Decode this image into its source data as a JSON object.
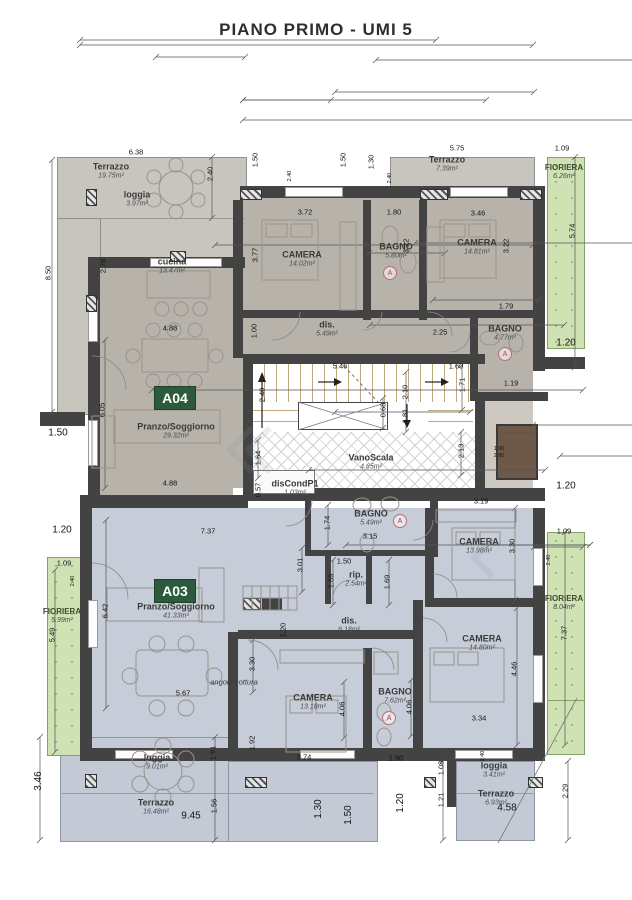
{
  "title": "PIANO PRIMO - UMI 5",
  "badges": {
    "a04": "A04",
    "a03": "A03"
  },
  "colors": {
    "badge_green": "#2c5a3c",
    "apartment_a04_fill": "#b7b2aa",
    "apartment_a03_fill": "#c6ccd8",
    "terrace_fill": "#c8c5bf",
    "terrace_blue_fill": "#c3cad6",
    "fioriera_green": "#cfe2b4",
    "stair_tan": "#ead9b6",
    "wall_dark": "#434343",
    "shaft_brown": "#6e5847"
  },
  "rooms": [
    [
      "Terrazzo",
      "19.75m²",
      111,
      171,
      ""
    ],
    [
      "loggia",
      "3.97m²",
      137,
      199,
      ""
    ],
    [
      "cucina",
      "13.47m²",
      172,
      266,
      ""
    ],
    [
      "CAMERA",
      "14.02m²",
      302,
      259,
      ""
    ],
    [
      "BAGNO",
      "5.80m²",
      396,
      251,
      ""
    ],
    [
      "CAMERA",
      "14.81m²",
      477,
      247,
      ""
    ],
    [
      "Terrazzo",
      "7.39m²",
      447,
      164,
      ""
    ],
    [
      "FIORIERA",
      "6.26m²",
      564,
      172,
      "fiolab"
    ],
    [
      "dis.",
      "5.49m²",
      327,
      329,
      ""
    ],
    [
      "BAGNO",
      "4.77m²",
      505,
      333,
      ""
    ],
    [
      "Pranzo/Soggiorno",
      "29.32m²",
      176,
      431,
      ""
    ],
    [
      "VanoScala",
      "4.65m²",
      371,
      462,
      ""
    ],
    [
      "disCondP1",
      "1.03m²",
      295,
      488,
      ""
    ],
    [
      "BAGNO",
      "5.49m²",
      371,
      518,
      ""
    ],
    [
      "rip.",
      "2.54m²",
      356,
      579,
      ""
    ],
    [
      "dis.",
      "6.18m²",
      349,
      625,
      ""
    ],
    [
      "CAMERA",
      "13.98m²",
      479,
      546,
      ""
    ],
    [
      "CAMERA",
      "14.80m²",
      482,
      643,
      ""
    ],
    [
      "CAMERA",
      "13.18m²",
      313,
      702,
      ""
    ],
    [
      "BAGNO",
      "7.62m²",
      395,
      696,
      ""
    ],
    [
      "FIORIERA",
      "5.99m²",
      62,
      616,
      "fiolab"
    ],
    [
      "FIORIERA",
      "8.04m²",
      564,
      603,
      "fiolab"
    ],
    [
      "angolo cottura",
      "",
      234,
      682,
      "sm"
    ],
    [
      "Pranzo/Soggiorno",
      "41.33m²",
      176,
      611,
      ""
    ],
    [
      "loggia",
      "9.01m²",
      157,
      762,
      ""
    ],
    [
      "Terrazzo",
      "16.48m²",
      156,
      807,
      ""
    ],
    [
      "loggia",
      "3.41m²",
      494,
      770,
      ""
    ],
    [
      "Terrazzo",
      "6.93m²",
      496,
      798,
      ""
    ]
  ],
  "dims": [
    [
      "6.38",
      136,
      152,
      ""
    ],
    [
      "5.75",
      457,
      148,
      ""
    ],
    [
      "1.09",
      562,
      148,
      ""
    ],
    [
      "3.72",
      305,
      212,
      ""
    ],
    [
      "1.80",
      394,
      212,
      ""
    ],
    [
      "3.46",
      478,
      213,
      ""
    ],
    [
      "4.88",
      170,
      328,
      ""
    ],
    [
      "2.25",
      440,
      332,
      ""
    ],
    [
      "1.79",
      506,
      306,
      ""
    ],
    [
      "1.20",
      566,
      343,
      "l"
    ],
    [
      "5.46",
      340,
      366,
      ""
    ],
    [
      "1.60",
      456,
      366,
      ""
    ],
    [
      "1.19",
      511,
      383,
      ""
    ],
    [
      "4.88",
      170,
      483,
      ""
    ],
    [
      "1.20",
      566,
      486,
      "l"
    ],
    [
      "1.50",
      58,
      433,
      "l"
    ],
    [
      "1.20",
      62,
      530,
      "l"
    ],
    [
      "1.09",
      64,
      563,
      ""
    ],
    [
      "7.37",
      208,
      531,
      ""
    ],
    [
      "3.15",
      370,
      536,
      ""
    ],
    [
      "1.50",
      344,
      561,
      ""
    ],
    [
      "3.19",
      481,
      501,
      ""
    ],
    [
      "1.09",
      564,
      531,
      ""
    ],
    [
      "5.67",
      183,
      693,
      ""
    ],
    [
      "3.74",
      304,
      757,
      ""
    ],
    [
      "1.90",
      396,
      758,
      ""
    ],
    [
      "3.34",
      479,
      718,
      ""
    ],
    [
      "4.58",
      507,
      808,
      "l"
    ],
    [
      "9.45",
      191,
      816,
      "l"
    ],
    [
      "1.50",
      255,
      160,
      "r"
    ],
    [
      "1.50",
      343,
      160,
      "r"
    ],
    [
      "1.30",
      371,
      162,
      "r"
    ],
    [
      "2.40",
      210,
      174,
      "r"
    ],
    [
      "5.74",
      572,
      231,
      "r"
    ],
    [
      "8.50",
      48,
      273,
      "r"
    ],
    [
      "2.76",
      103,
      266,
      "r"
    ],
    [
      "3.77",
      255,
      255,
      "r"
    ],
    [
      "3.22",
      406,
      246,
      "r"
    ],
    [
      "3.22",
      506,
      246,
      "r"
    ],
    [
      "6.05",
      102,
      410,
      "r"
    ],
    [
      "2.40",
      262,
      395,
      "r"
    ],
    [
      "2.10",
      405,
      392,
      "r"
    ],
    [
      "1.81",
      405,
      416,
      "r"
    ],
    [
      "0.68",
      383,
      410,
      "r"
    ],
    [
      "1.64",
      258,
      458,
      "r"
    ],
    [
      "0.57",
      258,
      490,
      "r"
    ],
    [
      "2.13",
      461,
      451,
      "r"
    ],
    [
      "1.71",
      462,
      385,
      "r"
    ],
    [
      "1.74",
      327,
      523,
      "r"
    ],
    [
      "3.01",
      300,
      565,
      "r"
    ],
    [
      "1.69",
      331,
      581,
      "r"
    ],
    [
      "1.69",
      387,
      582,
      "r"
    ],
    [
      "6.42",
      105,
      611,
      "r"
    ],
    [
      "5.49",
      52,
      635,
      "r"
    ],
    [
      "3.30",
      512,
      546,
      "r"
    ],
    [
      "7.37",
      564,
      633,
      "r"
    ],
    [
      "4.46",
      514,
      669,
      "r"
    ],
    [
      "3.46",
      39,
      781,
      "rl"
    ],
    [
      "1.91",
      213,
      753,
      "r"
    ],
    [
      "1.56",
      214,
      806,
      "r"
    ],
    [
      "1.30",
      319,
      809,
      "rl"
    ],
    [
      "1.50",
      349,
      815,
      "rl"
    ],
    [
      "1.20",
      401,
      803,
      "rl"
    ],
    [
      "3.30",
      252,
      664,
      "r"
    ],
    [
      "1.92",
      252,
      743,
      "r"
    ],
    [
      "4.06",
      342,
      709,
      "r"
    ],
    [
      "4.06",
      409,
      707,
      "r"
    ],
    [
      "1.08",
      441,
      768,
      "r"
    ],
    [
      "1.21",
      441,
      800,
      "r"
    ],
    [
      "2.29",
      565,
      791,
      "r"
    ],
    [
      "1.20",
      283,
      630,
      "r"
    ],
    [
      "1.00",
      254,
      331,
      "r"
    ],
    [
      "2.40",
      290,
      176,
      "rs"
    ],
    [
      "2.40",
      390,
      178,
      "rs"
    ],
    [
      "2.40",
      73,
      581,
      "rs"
    ],
    [
      "2.40",
      549,
      560,
      "rs"
    ],
    [
      "1.90",
      499,
      449,
      "s"
    ],
    [
      "2.80",
      499,
      456,
      "s"
    ],
    [
      "2.40",
      483,
      756,
      "rs"
    ]
  ],
  "markers": [
    [
      "A",
      390,
      273
    ],
    [
      "A",
      505,
      354
    ],
    [
      "A",
      400,
      521
    ],
    [
      "A",
      389,
      718
    ]
  ]
}
